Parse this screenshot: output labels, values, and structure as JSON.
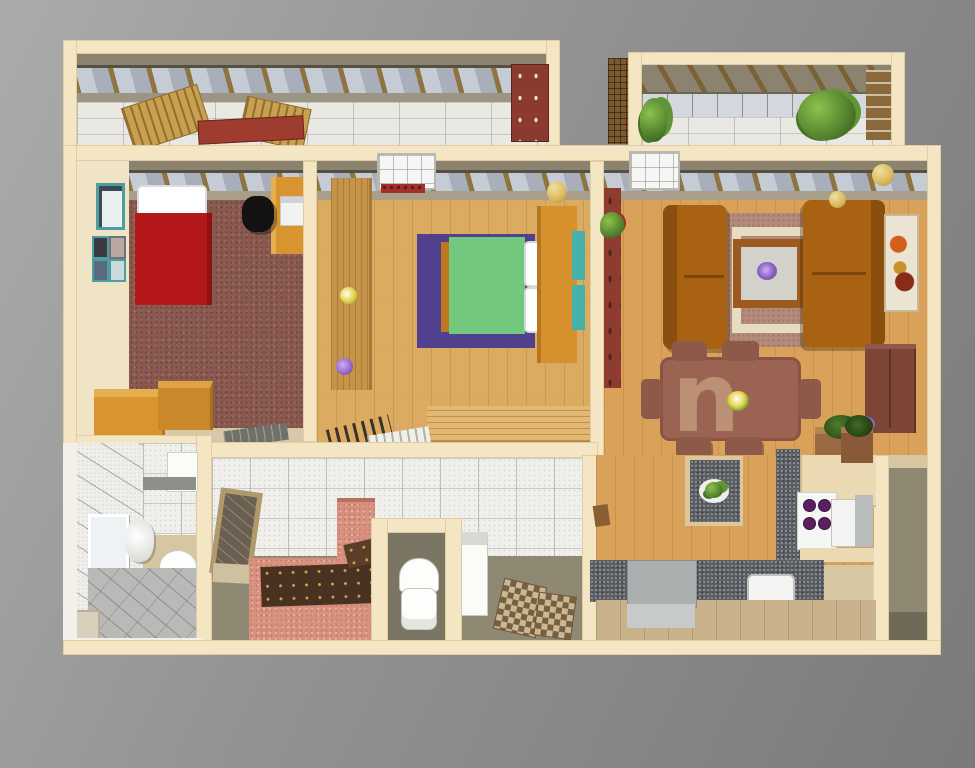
{
  "scene": {
    "title": "3D apartment floor plan rendering",
    "view": "top-down dollhouse cutaway",
    "background": "gray gradient"
  },
  "watermark": {
    "text": "n"
  },
  "palette": {
    "bg_top": "#ababab",
    "bg_mid": "#929292",
    "bg_bottom": "#7a7a7a",
    "wall_cream": "#f4e6c2",
    "wall_light": "#efe5c6",
    "wall_edge": "#e3d0a6",
    "band_olive": "#8b8370",
    "floor_olive": "#8f8974",
    "floor_olive_dark": "#7b7664",
    "glass": "#c6ccd5",
    "glass_dark": "#a9afba",
    "glass_frame": "#55503f",
    "beam_wood": "#8d7440",
    "tile_base": "#f0efec",
    "carpet": "#8a5a50",
    "bed_red": "#b51818",
    "wood_light": "#dcab62",
    "wood_living": "#d9a159",
    "wardrobe": "#c59448",
    "rug_purple": "#50408e",
    "bed_green": "#72c97e",
    "headboard": "#d7902e",
    "teal": "#46b0aa",
    "sofa": "#a86212",
    "sofa_dark": "#8a4e0e",
    "rug_mauve": "#b48a7a",
    "rug_beige": "#e6dcc0",
    "table_wood": "#9c5a20",
    "dining": "#9a6352",
    "chair_brown": "#8d5a49",
    "chest": "#7d4536",
    "red_cabinet": "#8e3c30",
    "tub_pink": "#d9917f",
    "tub_deck": "#4a3222",
    "granite": "#5d6064",
    "island_gray": "#aab0b0",
    "kitchen_beige": "#c9b28b",
    "cabinet_cream": "#ead9b2",
    "orange": "#d7942f",
    "gold": "#d9b85c",
    "burner": "#5c2060"
  },
  "rooms": {
    "balcony_left": {
      "label": "Balcony (left)"
    },
    "balcony_right": {
      "label": "Balcony (right)"
    },
    "bedroom_left": {
      "label": "Bedroom"
    },
    "bedroom_middle": {
      "label": "Master bedroom"
    },
    "living_room": {
      "label": "Living room"
    },
    "bathroom": {
      "label": "Bathroom"
    },
    "toilet_room": {
      "label": "Toilet / bath"
    },
    "kitchen": {
      "label": "Kitchen"
    }
  },
  "furniture": {
    "deck_chair": "Wooden deck chair",
    "balcony_bench": "Red balcony bench",
    "storage_chest": "Balcony storage chest",
    "planter": "Balcony plant",
    "picture_frames": "Picture frames",
    "single_bed": "Single bed (red)",
    "desk": "Desk",
    "office_chair": "Office chair",
    "computer": "Computer",
    "drawers": "Chest of drawers",
    "door_mat": "Door mat",
    "wardrobe": "Wardrobe",
    "flower_pot": "Flower pot",
    "area_rug_purple": "Purple rug",
    "double_bed": "Double bed (green)",
    "pillow": "Pillow",
    "headboard_unit": "Headboard cabinet",
    "wall_shelf": "Teal wall shelf",
    "bench": "Low wooden bench",
    "wall_lamp": "Wall lamp",
    "skylight": "Skylight window",
    "shelf_cabinet": "Tall red cabinet",
    "sofa": "Brown sofa",
    "area_rug": "Living room rug",
    "coffee_table": "Coffee table",
    "painting": "Wall painting",
    "dining_table": "Dining table",
    "dining_chair": "Dining chair",
    "chest_cabinet": "Dark wardrobe cabinet",
    "plant_stand": "Plant stand",
    "mirror": "Mirror",
    "wash_basin": "Wash basin",
    "toilet": "Toilet",
    "shower_tray": "Shower tray",
    "vanity_mirror": "Leaning vanity mirror",
    "bathtub": "Tiled bathtub",
    "washer": "Washing machine",
    "bath_mat": "Bath mat",
    "kitchen_island": "Kitchen island",
    "stove": "Stove with burners",
    "microwave": "Microwave box",
    "kitchen_counter": "Granite counter",
    "kitchen_sink": "Kitchen sink",
    "prep_table": "Gray prep table",
    "counter_plant": "Counter plant"
  }
}
